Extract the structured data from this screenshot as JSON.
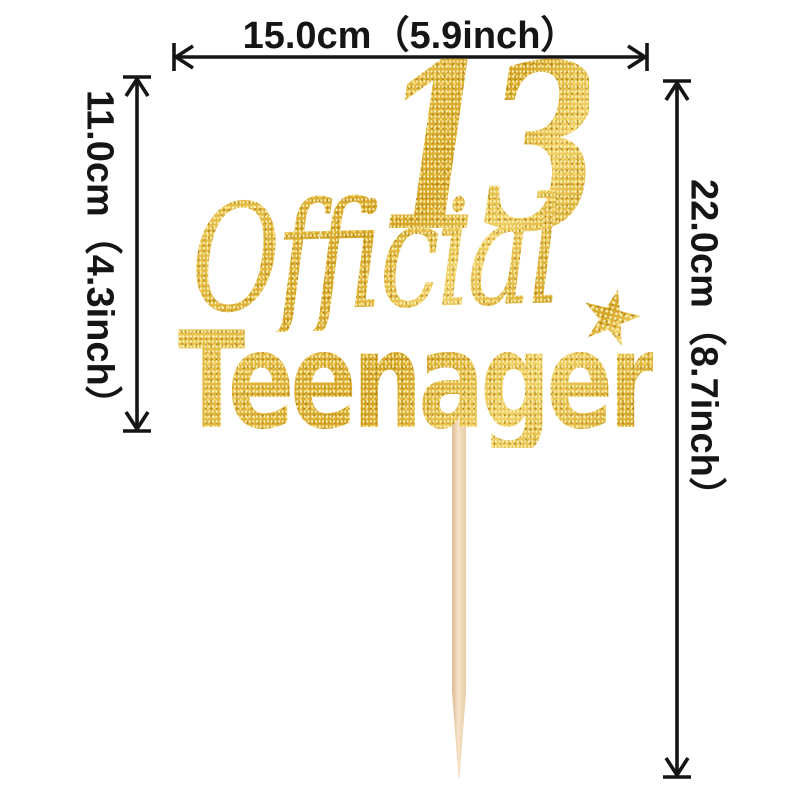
{
  "topper": {
    "number": "13",
    "word_script": "Official",
    "word_main": "Teenager",
    "star_icon": "★",
    "glitter_gold": "#d9a821",
    "stick_color": "#f0d6b8"
  },
  "dimensions": {
    "top_width": {
      "label": "15.0cm（5.9inch）"
    },
    "left_height": {
      "label": "11.0cm（4.3inch）"
    },
    "right_height": {
      "label": "22.0cm（8.7inch）"
    },
    "line_color": "#151515"
  }
}
